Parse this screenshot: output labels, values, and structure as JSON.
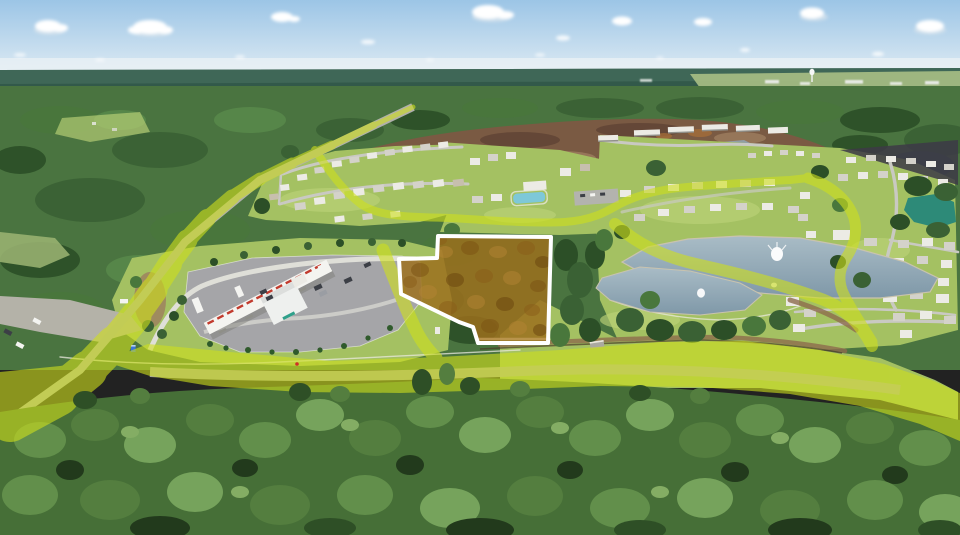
{
  "image": {
    "kind": "aerial-drone-photograph",
    "subject": "land-parcel-listing-photo"
  },
  "scene": {
    "parcel_highlight": "irregular wooded parcel with white boundary and amber tint overlay",
    "route_highlight": "yellow-green translucent overlay tracing highway, frontage road and development spine roads",
    "features": [
      "sky-with-cumulus-clouds",
      "distant-treeline",
      "cleared-dirt-construction-area",
      "residential-development",
      "townhome-row",
      "amenity-pool",
      "large-pond-with-fountain",
      "small-pond-with-fountain",
      "teal-pond",
      "gas-station-with-fuel-canopy",
      "highway-with-cars",
      "foreground-pine-forest",
      "water-tower-on-horizon"
    ]
  },
  "colors": {
    "sky_top": "#9cc5e6",
    "sky_horizon": "#e2edf4",
    "cloud": "#ffffff",
    "distant_forest": "#32594a",
    "distant_field": "#a8bf85",
    "structure_white": "#eef0ee",
    "forest_mid": "#4a7440",
    "grass": "#a4c162",
    "dirt": "#7a5a43",
    "asphalt": "#a5a5a8",
    "concrete": "#dfdfd8",
    "pond_light": "#a9bcc6",
    "pond": "#7f98a8",
    "pond_teal": "#2d8a78",
    "fountain": "#ffffff",
    "route_highlight": "#cfe01c",
    "route_opacity": "0.60",
    "parcel_fill": "#9c6f1d",
    "parcel_fill_opacity": "0.82",
    "parcel_outline": "#ffffff",
    "canopy_red": "#c23b2e",
    "porta_blue": "#3a76d6",
    "sign_teal": "#2fa08a"
  }
}
